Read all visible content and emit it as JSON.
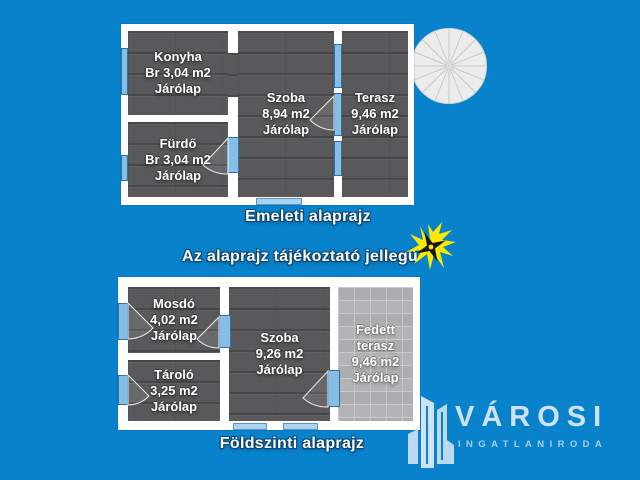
{
  "colors": {
    "background": "#0982cc",
    "wall_white": "#ffffff",
    "room_fill": "#59595b",
    "paved_terrace_fill": "#b3b4b6",
    "opening_blue": "#85bfe7",
    "opening_blue_light": "#a9d3ee",
    "caption_text": "#ffffff",
    "caption_outline": "#0a4573",
    "logo_light_blue": "#cfe2f4",
    "logo_sub_blue": "#a9cde9",
    "sparkle_yellow": "#f7ea00"
  },
  "upper_plan": {
    "caption": "Emeleti alaprajz",
    "rooms": {
      "konyha": {
        "lines": [
          "Konyha",
          "Br 3,04 m2",
          "Járólap"
        ]
      },
      "szoba": {
        "lines": [
          "Szoba",
          "8,94 m2",
          "Járólap"
        ]
      },
      "terasz": {
        "lines": [
          "Terasz",
          "9,46 m2",
          "Járólap"
        ]
      },
      "furdo": {
        "lines": [
          "Fürdő",
          "Br 3,04 m2",
          "Járólap"
        ]
      }
    }
  },
  "disclaimer": "Az alaprajz tájékoztató jellegű",
  "lower_plan": {
    "caption": "Földszinti alaprajz",
    "rooms": {
      "mosdo": {
        "lines": [
          "Mosdó",
          "4,02 m2",
          "Járólap"
        ]
      },
      "szoba": {
        "lines": [
          "Szoba",
          "9,26 m2",
          "Járólap"
        ]
      },
      "fedett_terasz": {
        "lines": [
          "Fedett",
          "terasz",
          "9,46 m2",
          "Járólap"
        ]
      },
      "tarolo": {
        "lines": [
          "Tároló",
          "3,25 m2",
          "Járólap"
        ]
      }
    }
  },
  "logo": {
    "brand": "VÁROSI",
    "subtitle": "INGATLANIRODA"
  },
  "icons": {
    "spiral_staircase": "spiral-staircase-icon",
    "sparkle": "star-burst-icon",
    "buildings": "buildings-logo-icon"
  }
}
